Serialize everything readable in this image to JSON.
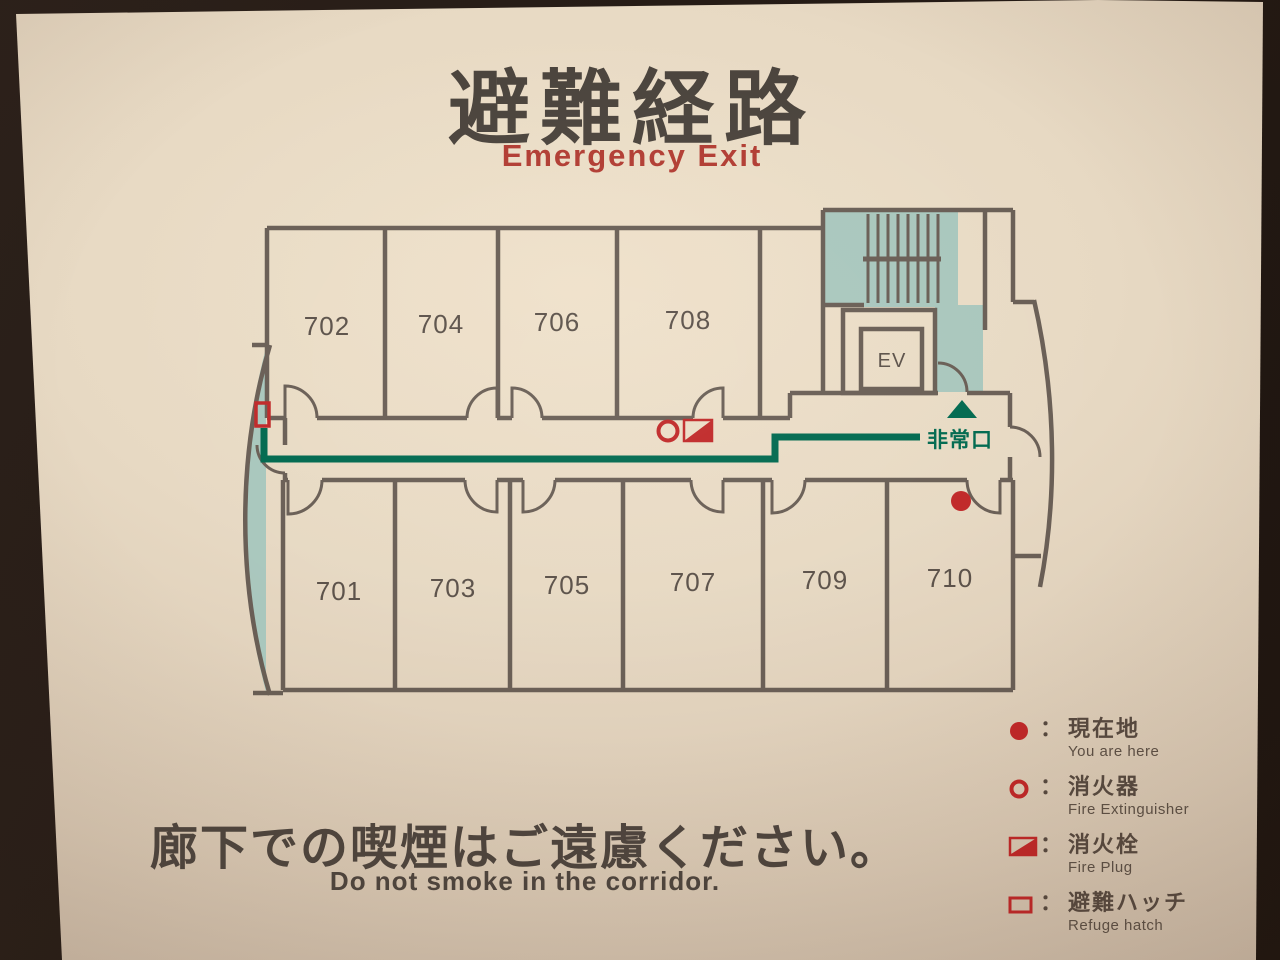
{
  "sign": {
    "title_jp": "避難経路",
    "subtitle_en": "Emergency Exit",
    "footer_jp": "廊下での喫煙はご遠慮ください。",
    "footer_en": "Do not smoke in the corridor."
  },
  "floorplan": {
    "rooms": [
      "702",
      "704",
      "706",
      "708",
      "701",
      "703",
      "705",
      "707",
      "709",
      "710"
    ],
    "elevator_label": "EV",
    "emergency_exit_label": "非常口"
  },
  "legend": {
    "separator": "：",
    "items": [
      {
        "icon": "you-are-here-dot",
        "jp": "現在地",
        "en": "You are here"
      },
      {
        "icon": "fire-extinguisher-circle",
        "jp": "消火器",
        "en": "Fire Extinguisher"
      },
      {
        "icon": "fire-plug-flag",
        "jp": "消火栓",
        "en": "Fire Plug"
      },
      {
        "icon": "refuge-hatch-rect",
        "jp": "避難ハッチ",
        "en": "Refuge hatch"
      }
    ]
  },
  "colors": {
    "wall": "#695e55",
    "route_green": "#00694f",
    "marker_red": "#c02828",
    "stair_teal": "#a9c7bd",
    "accent_red": "#b13c32"
  }
}
